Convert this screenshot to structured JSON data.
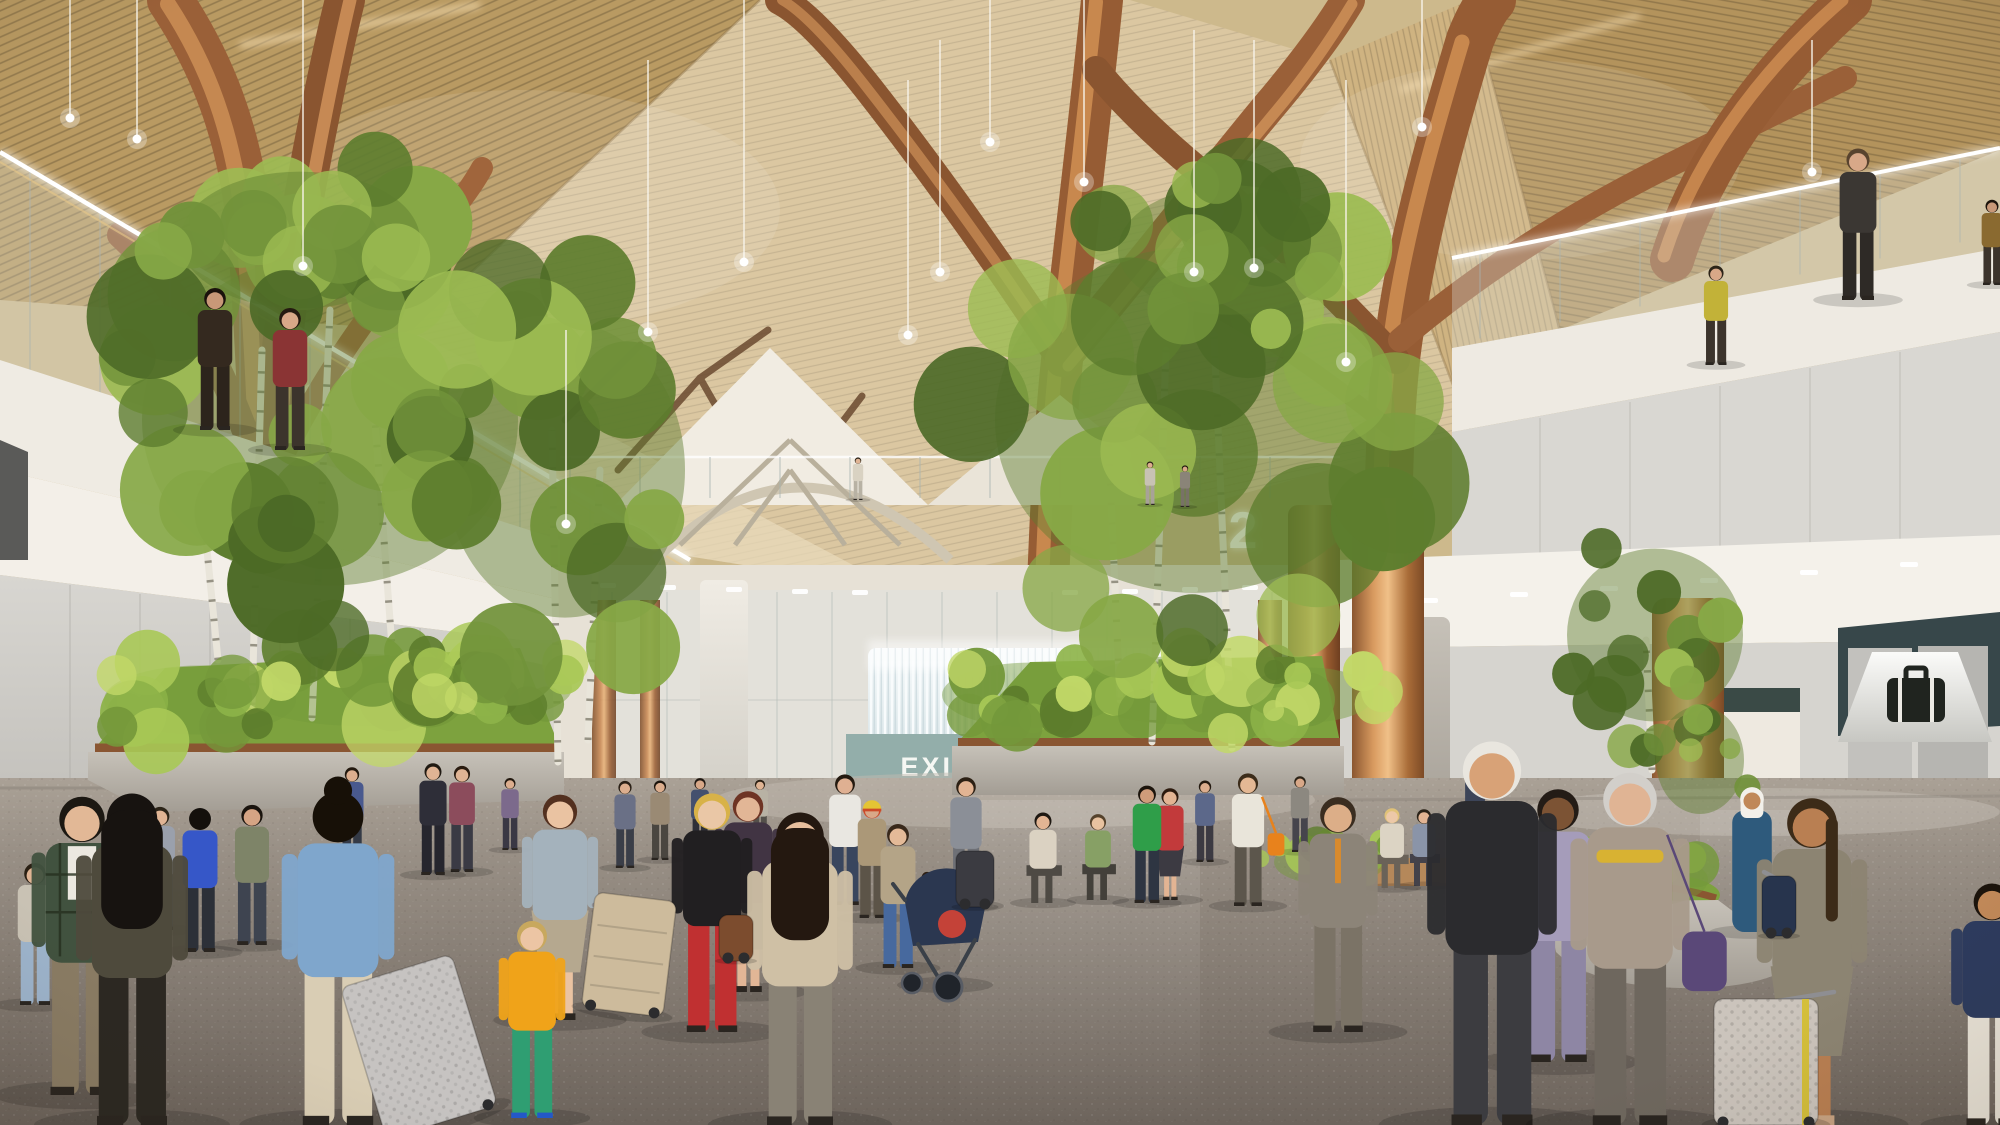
{
  "meta": {
    "title": "Airport terminal great hall — architectural rendering",
    "alt": "Photorealistic rendering of an airport terminal interior with faceted wood-slat ceiling, branching copper tree columns, pendant lights, birch trees in planters, mezzanine walkways and travelers with luggage"
  },
  "signs": {
    "exit_sign": "EXIT ONLY",
    "level_number": "2",
    "baggage_sign_icon": "suitcase-pictogram"
  },
  "colors": {
    "wood_ceiling": "#c7a566",
    "wood_pale": "#dbc7a1",
    "copper": "#b87c4c",
    "wall_white": "#efebe3",
    "wall_gray": "#c9c8c4",
    "glass": "#dfe6e3",
    "exit_portal_teal": "#93aeaa",
    "exit_text": "#f5f7f3",
    "counter_yellow": "#f4a81f",
    "bench_navy": "#2d3850",
    "baggage_band_teal": "#37474a",
    "baggage_sign_bg": "#e9e8e3",
    "baggage_icon": "#20241f",
    "foliage_green": "#71923a",
    "grass": "#7da23e",
    "planter_concrete": "#b6b1a8",
    "floor": "#8a8178",
    "level_sign": "#fdfdf8",
    "red_accent_strip": "#b8352f"
  },
  "scene": {
    "lights": [
      [
        70,
        -20,
        118
      ],
      [
        137,
        -20,
        139
      ],
      [
        303,
        -10,
        266
      ],
      [
        566,
        330,
        524
      ],
      [
        648,
        60,
        332
      ],
      [
        744,
        0,
        262
      ],
      [
        908,
        80,
        335
      ],
      [
        940,
        40,
        272
      ],
      [
        990,
        -10,
        142
      ],
      [
        1084,
        0,
        182
      ],
      [
        1194,
        30,
        272
      ],
      [
        1254,
        40,
        268
      ],
      [
        1346,
        80,
        362
      ],
      [
        1422,
        -10,
        127
      ],
      [
        1812,
        40,
        172
      ]
    ],
    "trees": [
      {
        "x": 330,
        "y": 420,
        "rx": 235,
        "ry": 230,
        "n": 26,
        "seed": 7,
        "pal": "tree"
      },
      {
        "x": 300,
        "y": 240,
        "rx": 150,
        "ry": 95,
        "n": 12,
        "seed": 11,
        "pal": "tree"
      },
      {
        "x": 565,
        "y": 470,
        "rx": 150,
        "ry": 205,
        "n": 18,
        "seed": 3,
        "pal": "tree"
      },
      {
        "x": 1195,
        "y": 420,
        "rx": 250,
        "ry": 240,
        "n": 26,
        "seed": 5,
        "pal": "tree"
      },
      {
        "x": 1230,
        "y": 250,
        "rx": 140,
        "ry": 90,
        "n": 10,
        "seed": 9,
        "pal": "tree"
      },
      {
        "x": 1655,
        "y": 635,
        "rx": 110,
        "ry": 120,
        "n": 14,
        "seed": 13,
        "pal": "tree"
      },
      {
        "x": 1700,
        "y": 760,
        "rx": 55,
        "ry": 75,
        "n": 8,
        "seed": 17,
        "pal": "tree"
      }
    ],
    "trunks": [
      [
        252,
        705,
        262,
        350
      ],
      [
        312,
        718,
        330,
        310
      ],
      [
        396,
        700,
        372,
        380
      ],
      [
        218,
        660,
        200,
        480
      ],
      [
        558,
        762,
        552,
        430
      ],
      [
        588,
        740,
        600,
        470
      ],
      [
        1152,
        742,
        1166,
        350
      ],
      [
        1232,
        748,
        1214,
        335
      ],
      [
        1120,
        700,
        1108,
        430
      ],
      [
        1652,
        770,
        1646,
        640
      ]
    ],
    "bushes": [
      {
        "x": 200,
        "y": 700,
        "rx": 120,
        "ry": 48,
        "n": 14,
        "seed": 21
      },
      {
        "x": 360,
        "y": 690,
        "rx": 150,
        "ry": 50,
        "n": 16,
        "seed": 23
      },
      {
        "x": 500,
        "y": 688,
        "rx": 90,
        "ry": 40,
        "n": 10,
        "seed": 25
      },
      {
        "x": 1030,
        "y": 695,
        "rx": 110,
        "ry": 45,
        "n": 12,
        "seed": 27
      },
      {
        "x": 1190,
        "y": 690,
        "rx": 140,
        "ry": 48,
        "n": 14,
        "seed": 29
      },
      {
        "x": 1310,
        "y": 695,
        "rx": 80,
        "ry": 38,
        "n": 9,
        "seed": 31
      },
      {
        "x": 1640,
        "y": 880,
        "rx": 85,
        "ry": 38,
        "n": 10,
        "seed": 33
      },
      {
        "x": 1330,
        "y": 862,
        "rx": 70,
        "ry": 32,
        "n": 9,
        "seed": 37
      }
    ],
    "people": [
      {
        "x": 82,
        "y": 1095,
        "h": 315,
        "top": "#41523f",
        "bot": "#8a7c64",
        "hair": "#1c1812",
        "skin": "#e2b896",
        "tee": 1,
        "plaid": "#26301f"
      },
      {
        "x": 132,
        "y": 1125,
        "h": 350,
        "top": "#4e4a3c",
        "bot": "#2c2822",
        "hair": "#171310",
        "skin": "#dfb294",
        "longhair": 1,
        "back": 1
      },
      {
        "x": 338,
        "y": 1125,
        "h": 352,
        "top": "#7fa6cc",
        "bot": "#d9cdb4",
        "hair": "#171007",
        "skin": "#d9a988",
        "bun": 1,
        "back": 1
      },
      {
        "x": 532,
        "y": 1118,
        "h": 208,
        "top": "#f0a319",
        "bot": "#2f9e72",
        "hair": "#c8a85e",
        "skin": "#ecc5a4",
        "shoe": "#2458c8"
      },
      {
        "x": 560,
        "y": 1020,
        "h": 238,
        "top": "#a4b2bc",
        "bot": "#b5a88f",
        "hair": "#53301f",
        "skin": "#eac3a2",
        "skirt": 1
      },
      {
        "x": 800,
        "y": 1125,
        "h": 330,
        "top": "#cfc0a5",
        "bot": "#898275",
        "hair": "#241810",
        "skin": "#e6bd9c",
        "longhair": 1
      },
      {
        "x": 712,
        "y": 1032,
        "h": 252,
        "top": "#211f21",
        "bot": "#c03031",
        "hair": "#d8b248",
        "skin": "#eac7a6"
      },
      {
        "x": 748,
        "y": 992,
        "h": 212,
        "top": "#413443",
        "bot": "#58504a",
        "hair": "#6e3424",
        "skin": "#e2b696",
        "skirt": 1
      },
      {
        "x": 200,
        "y": 952,
        "h": 152,
        "top": "#3657c8",
        "bot": "#2c3038",
        "hair": "#14100c",
        "skin": "#d9a888",
        "back": 1
      },
      {
        "x": 252,
        "y": 945,
        "h": 148,
        "top": "#7e8468",
        "bot": "#3e4450",
        "hair": "#1a140e",
        "skin": "#d5a484"
      },
      {
        "x": 433,
        "y": 875,
        "h": 118,
        "top": "#2e2e38",
        "bot": "#26262e",
        "hair": "#201a12",
        "skin": "#e0b494"
      },
      {
        "x": 462,
        "y": 872,
        "h": 112,
        "top": "#8c4c5c",
        "bot": "#3a3a44",
        "hair": "#2a1c10",
        "skin": "#e0b494"
      },
      {
        "x": 352,
        "y": 862,
        "h": 100,
        "top": "#49598e",
        "bot": "#343a46",
        "hair": "#22180e",
        "skin": "#dcae8e"
      },
      {
        "x": 898,
        "y": 968,
        "h": 152,
        "top": "#b4a487",
        "bot": "#47699e",
        "hair": "#39291b",
        "skin": "#e4ba98"
      },
      {
        "x": 927,
        "y": 942,
        "h": 74,
        "top": "#cf3b33",
        "bot": "#b08434",
        "hair": "#2e1f12",
        "skin": "#ecc5a4"
      },
      {
        "x": 872,
        "y": 918,
        "h": 124,
        "top": "#ab9878",
        "bot": "#5c5448",
        "hair": "#cc4a28",
        "skin": "#d8a888",
        "beanie": "#e4c434"
      },
      {
        "x": 845,
        "y": 905,
        "h": 138,
        "top": "#e9e7e1",
        "bot": "#39465e",
        "hair": "#241a10",
        "skin": "#dfb092"
      },
      {
        "x": 966,
        "y": 906,
        "h": 136,
        "top": "#8b8f97",
        "bot": "#6e7076",
        "hair": "#2c2014",
        "skin": "#e2b493"
      },
      {
        "x": 1043,
        "y": 903,
        "h": 118,
        "top": "#dbd2c2",
        "bot": "#4e4a44",
        "hair": "#1e1812",
        "skin": "#e2b493",
        "sit": 1
      },
      {
        "x": 1098,
        "y": 900,
        "h": 112,
        "top": "#87a065",
        "bot": "#43403a",
        "hair": "#55422c",
        "skin": "#e8c2a0",
        "sit": 1
      },
      {
        "x": 1147,
        "y": 903,
        "h": 124,
        "top": "#2f9e49",
        "bot": "#2e3542",
        "hair": "#1c140c",
        "skin": "#cf9c7a"
      },
      {
        "x": 1170,
        "y": 900,
        "h": 118,
        "top": "#c23a3b",
        "bot": "#3c3a42",
        "hair": "#2c1a0e",
        "skin": "#e2b493",
        "skirt": 1
      },
      {
        "x": 1248,
        "y": 906,
        "h": 140,
        "top": "#e9e5da",
        "bot": "#5c564c",
        "hair": "#3c2c1a",
        "skin": "#e4b894",
        "bag": "#e8821c"
      },
      {
        "x": 1338,
        "y": 1032,
        "h": 248,
        "top": "#8c8478",
        "bot": "#7b7366",
        "hair": "#3a2d20",
        "skin": "#dcae88",
        "tie": "#d88a2c"
      },
      {
        "x": 1392,
        "y": 888,
        "h": 104,
        "top": "#dcd4c4",
        "bot": "#6a6258",
        "hair": "#e0c278",
        "skin": "#ecc8a8",
        "sit": 1
      },
      {
        "x": 1424,
        "y": 886,
        "h": 100,
        "top": "#8a94a8",
        "bot": "#44424a",
        "hair": "#2a2218",
        "skin": "#e2b493",
        "sit": 1
      },
      {
        "x": 1492,
        "y": 1125,
        "h": 405,
        "top": "#2b2b2e",
        "bot": "#3c3c40",
        "hair": "#e9e6df",
        "skin": "#d8a277"
      },
      {
        "x": 1558,
        "y": 1062,
        "h": 288,
        "top": "#a59cba",
        "bot": "#8e86a4",
        "hair": "#241c16",
        "skin": "#7c5334"
      },
      {
        "x": 1630,
        "y": 1125,
        "h": 372,
        "top": "#a89a8b",
        "bot": "#6e675e",
        "hair": "#d2cfca",
        "skin": "#e0b494",
        "scarf": "#d8b232",
        "bag": "#5a4878"
      },
      {
        "x": 1752,
        "y": 932,
        "h": 152,
        "top": "#2e5a7c",
        "bot": "#2e5a7c",
        "hair": "#f2f0ea",
        "skin": "#c08858",
        "robe": 1,
        "ghutra": 1
      },
      {
        "x": 1812,
        "y": 1125,
        "h": 345,
        "top": "#8c8472",
        "bot": "#8c8472",
        "hair": "#3c2b18",
        "skin": "#b97f52",
        "skirt": 1,
        "pony": 1,
        "shoe": "#c9a484"
      },
      {
        "x": 1992,
        "y": 1125,
        "h": 255,
        "top": "#2d3b5e",
        "bot": "#e9e3d7",
        "hair": "#1c140c",
        "skin": "#c08858"
      },
      {
        "x": 625,
        "y": 868,
        "h": 92,
        "top": "#6a7086",
        "bot": "#3a3e48",
        "hair": "#2a2016",
        "skin": "#dcae8e"
      },
      {
        "x": 660,
        "y": 860,
        "h": 84,
        "top": "#9a8a74",
        "bot": "#4a4640",
        "hair": "#1c140c",
        "skin": "#dcae8e"
      },
      {
        "x": 700,
        "y": 852,
        "h": 78,
        "top": "#44506e",
        "bot": "#2e3038",
        "hair": "#201812",
        "skin": "#d8a888"
      },
      {
        "x": 760,
        "y": 846,
        "h": 70,
        "top": "#b8b2a4",
        "bot": "#54504a",
        "hair": "#2c2014",
        "skin": "#e0b494"
      },
      {
        "x": 1205,
        "y": 862,
        "h": 86,
        "top": "#5c688a",
        "bot": "#3c3a42",
        "hair": "#241a10",
        "skin": "#dcae8e"
      },
      {
        "x": 1300,
        "y": 852,
        "h": 80,
        "top": "#8c8880",
        "bot": "#46444c",
        "hair": "#2c2418",
        "skin": "#d8a888"
      },
      {
        "x": 1475,
        "y": 848,
        "h": 86,
        "top": "#3c4458",
        "bot": "#2e2c34",
        "hair": "#1c140c",
        "skin": "#c89878"
      },
      {
        "x": 510,
        "y": 850,
        "h": 76,
        "top": "#7c6a8c",
        "bot": "#3a3844",
        "hair": "#22180e",
        "skin": "#dcae8e"
      },
      {
        "x": 160,
        "y": 930,
        "h": 130,
        "top": "#9aa0ac",
        "bot": "#4c5058",
        "hair": "#2c2418",
        "skin": "#e0b494"
      },
      {
        "x": 35,
        "y": 1005,
        "h": 150,
        "top": "#c9c2b4",
        "bot": "#9db4cc",
        "hair": "#2a2014",
        "skin": "#e0b494"
      },
      {
        "x": 215,
        "y": 430,
        "h": 150,
        "top": "#34291f",
        "bot": "#2c241c",
        "hair": "#1a120c",
        "skin": "#c89878"
      },
      {
        "x": 290,
        "y": 450,
        "h": 150,
        "top": "#8a3434",
        "bot": "#3c342c",
        "hair": "#241a10",
        "skin": "#d8a888"
      },
      {
        "x": 858,
        "y": 500,
        "h": 45,
        "top": "#d9d2c2",
        "bot": "#b8b2a4",
        "hair": "#2c2418",
        "skin": "#e0b494"
      },
      {
        "x": 1150,
        "y": 505,
        "h": 46,
        "top": "#c8c2b4",
        "bot": "#a8a298",
        "hair": "#2a2016",
        "skin": "#dcae8e"
      },
      {
        "x": 1185,
        "y": 507,
        "h": 44,
        "top": "#8a8478",
        "bot": "#787266",
        "hair": "#1c140c",
        "skin": "#d8a888"
      },
      {
        "x": 1716,
        "y": 365,
        "h": 105,
        "top": "#c2b238",
        "bot": "#3c342c",
        "hair": "#2c2418",
        "skin": "#d8a888"
      },
      {
        "x": 1858,
        "y": 300,
        "h": 160,
        "top": "#3b3733",
        "bot": "#2e2a26",
        "hair": "#58432e",
        "skin": "#d8a888"
      },
      {
        "x": 1992,
        "y": 285,
        "h": 90,
        "top": "#8a6a30",
        "bot": "#3c342c",
        "hair": "#1c140c",
        "skin": "#c89878"
      }
    ],
    "suitcases": [
      {
        "x": 442,
        "y": 1122,
        "w": 116,
        "h": 158,
        "c": "#c6c3c1",
        "rot": -17,
        "dim": 1,
        "hx": 372,
        "hy": 982
      },
      {
        "x": 622,
        "y": 1012,
        "w": 82,
        "h": 116,
        "c": "#cdbb9c",
        "rot": 7,
        "ribs": 1,
        "hx": 594,
        "hy": 905
      },
      {
        "x": 1779,
        "y": 936,
        "w": 34,
        "h": 60,
        "c": "#27344d",
        "rot": 0,
        "hx": 1764,
        "hy": 872
      },
      {
        "x": 1766,
        "y": 1125,
        "w": 104,
        "h": 126,
        "c": "#cbc4bc",
        "rot": 0,
        "dim": 1,
        "stripe": "#d4bf3a",
        "hx": 1834,
        "hy": 992
      },
      {
        "x": 975,
        "y": 907,
        "w": 38,
        "h": 56,
        "c": "#3b3b41",
        "rot": 0
      },
      {
        "x": 736,
        "y": 961,
        "w": 34,
        "h": 46,
        "c": "#7c4c2e",
        "rot": 0
      }
    ]
  }
}
